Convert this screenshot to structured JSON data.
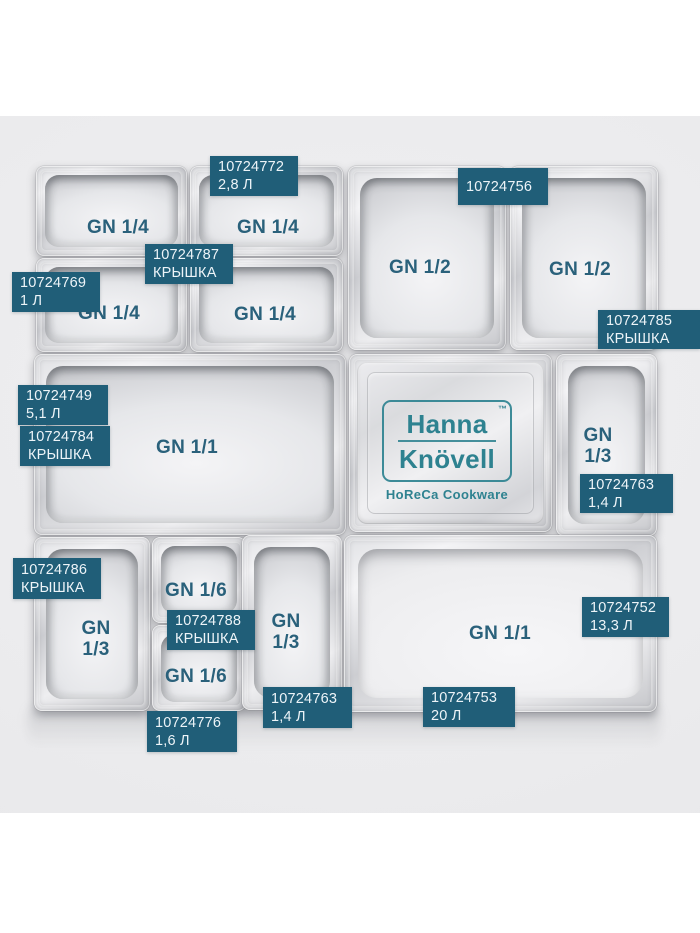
{
  "photo": {
    "background": "#ebebed"
  },
  "colors": {
    "tag_background": "#205e78",
    "tag_text": "#edf4f8",
    "gn_label": "#2a617b",
    "brand_teal": "#2e8290"
  },
  "brand": {
    "name_line1": "Hanna",
    "name_line2": "Knövell",
    "trademark": "™",
    "tagline": "HoReCa Cookware"
  },
  "pans": [
    {
      "label": "GN 1/4"
    },
    {
      "label": "GN 1/4"
    },
    {
      "label": "GN 1/4"
    },
    {
      "label": "GN 1/4"
    },
    {
      "label": "GN 1/2"
    },
    {
      "label": "GN 1/2"
    },
    {
      "label": "GN 1/1"
    },
    {
      "label_top": "GN",
      "label_bottom": "1/3"
    },
    {
      "label_top": "GN",
      "label_bottom": "1/3"
    },
    {
      "label": "GN 1/6"
    },
    {
      "label": "GN 1/6"
    },
    {
      "label_top": "GN",
      "label_bottom": "1/3"
    },
    {
      "label": "GN 1/1"
    }
  ],
  "tags": [
    {
      "line1": "10724772",
      "line2": "2,8 Л"
    },
    {
      "line1": "10724756"
    },
    {
      "line1": "10724787",
      "line2": "КРЫШКА"
    },
    {
      "line1": "10724769",
      "line2": "1 Л"
    },
    {
      "line1": "10724785",
      "line2": "КРЫШКА"
    },
    {
      "line1": "10724749",
      "line2": "5,1 Л"
    },
    {
      "line1": "10724784",
      "line2": "КРЫШКА"
    },
    {
      "line1": "10724763",
      "line2": "1,4 Л"
    },
    {
      "line1": "10724786",
      "line2": "КРЫШКА"
    },
    {
      "line1": "10724788",
      "line2": "КРЫШКА"
    },
    {
      "line1": "10724752",
      "line2": "13,3 Л"
    },
    {
      "line1": "10724763",
      "line2": "1,4 Л"
    },
    {
      "line1": "10724753",
      "line2": "20 Л"
    },
    {
      "line1": "10724776",
      "line2": "1,6 Л"
    }
  ]
}
